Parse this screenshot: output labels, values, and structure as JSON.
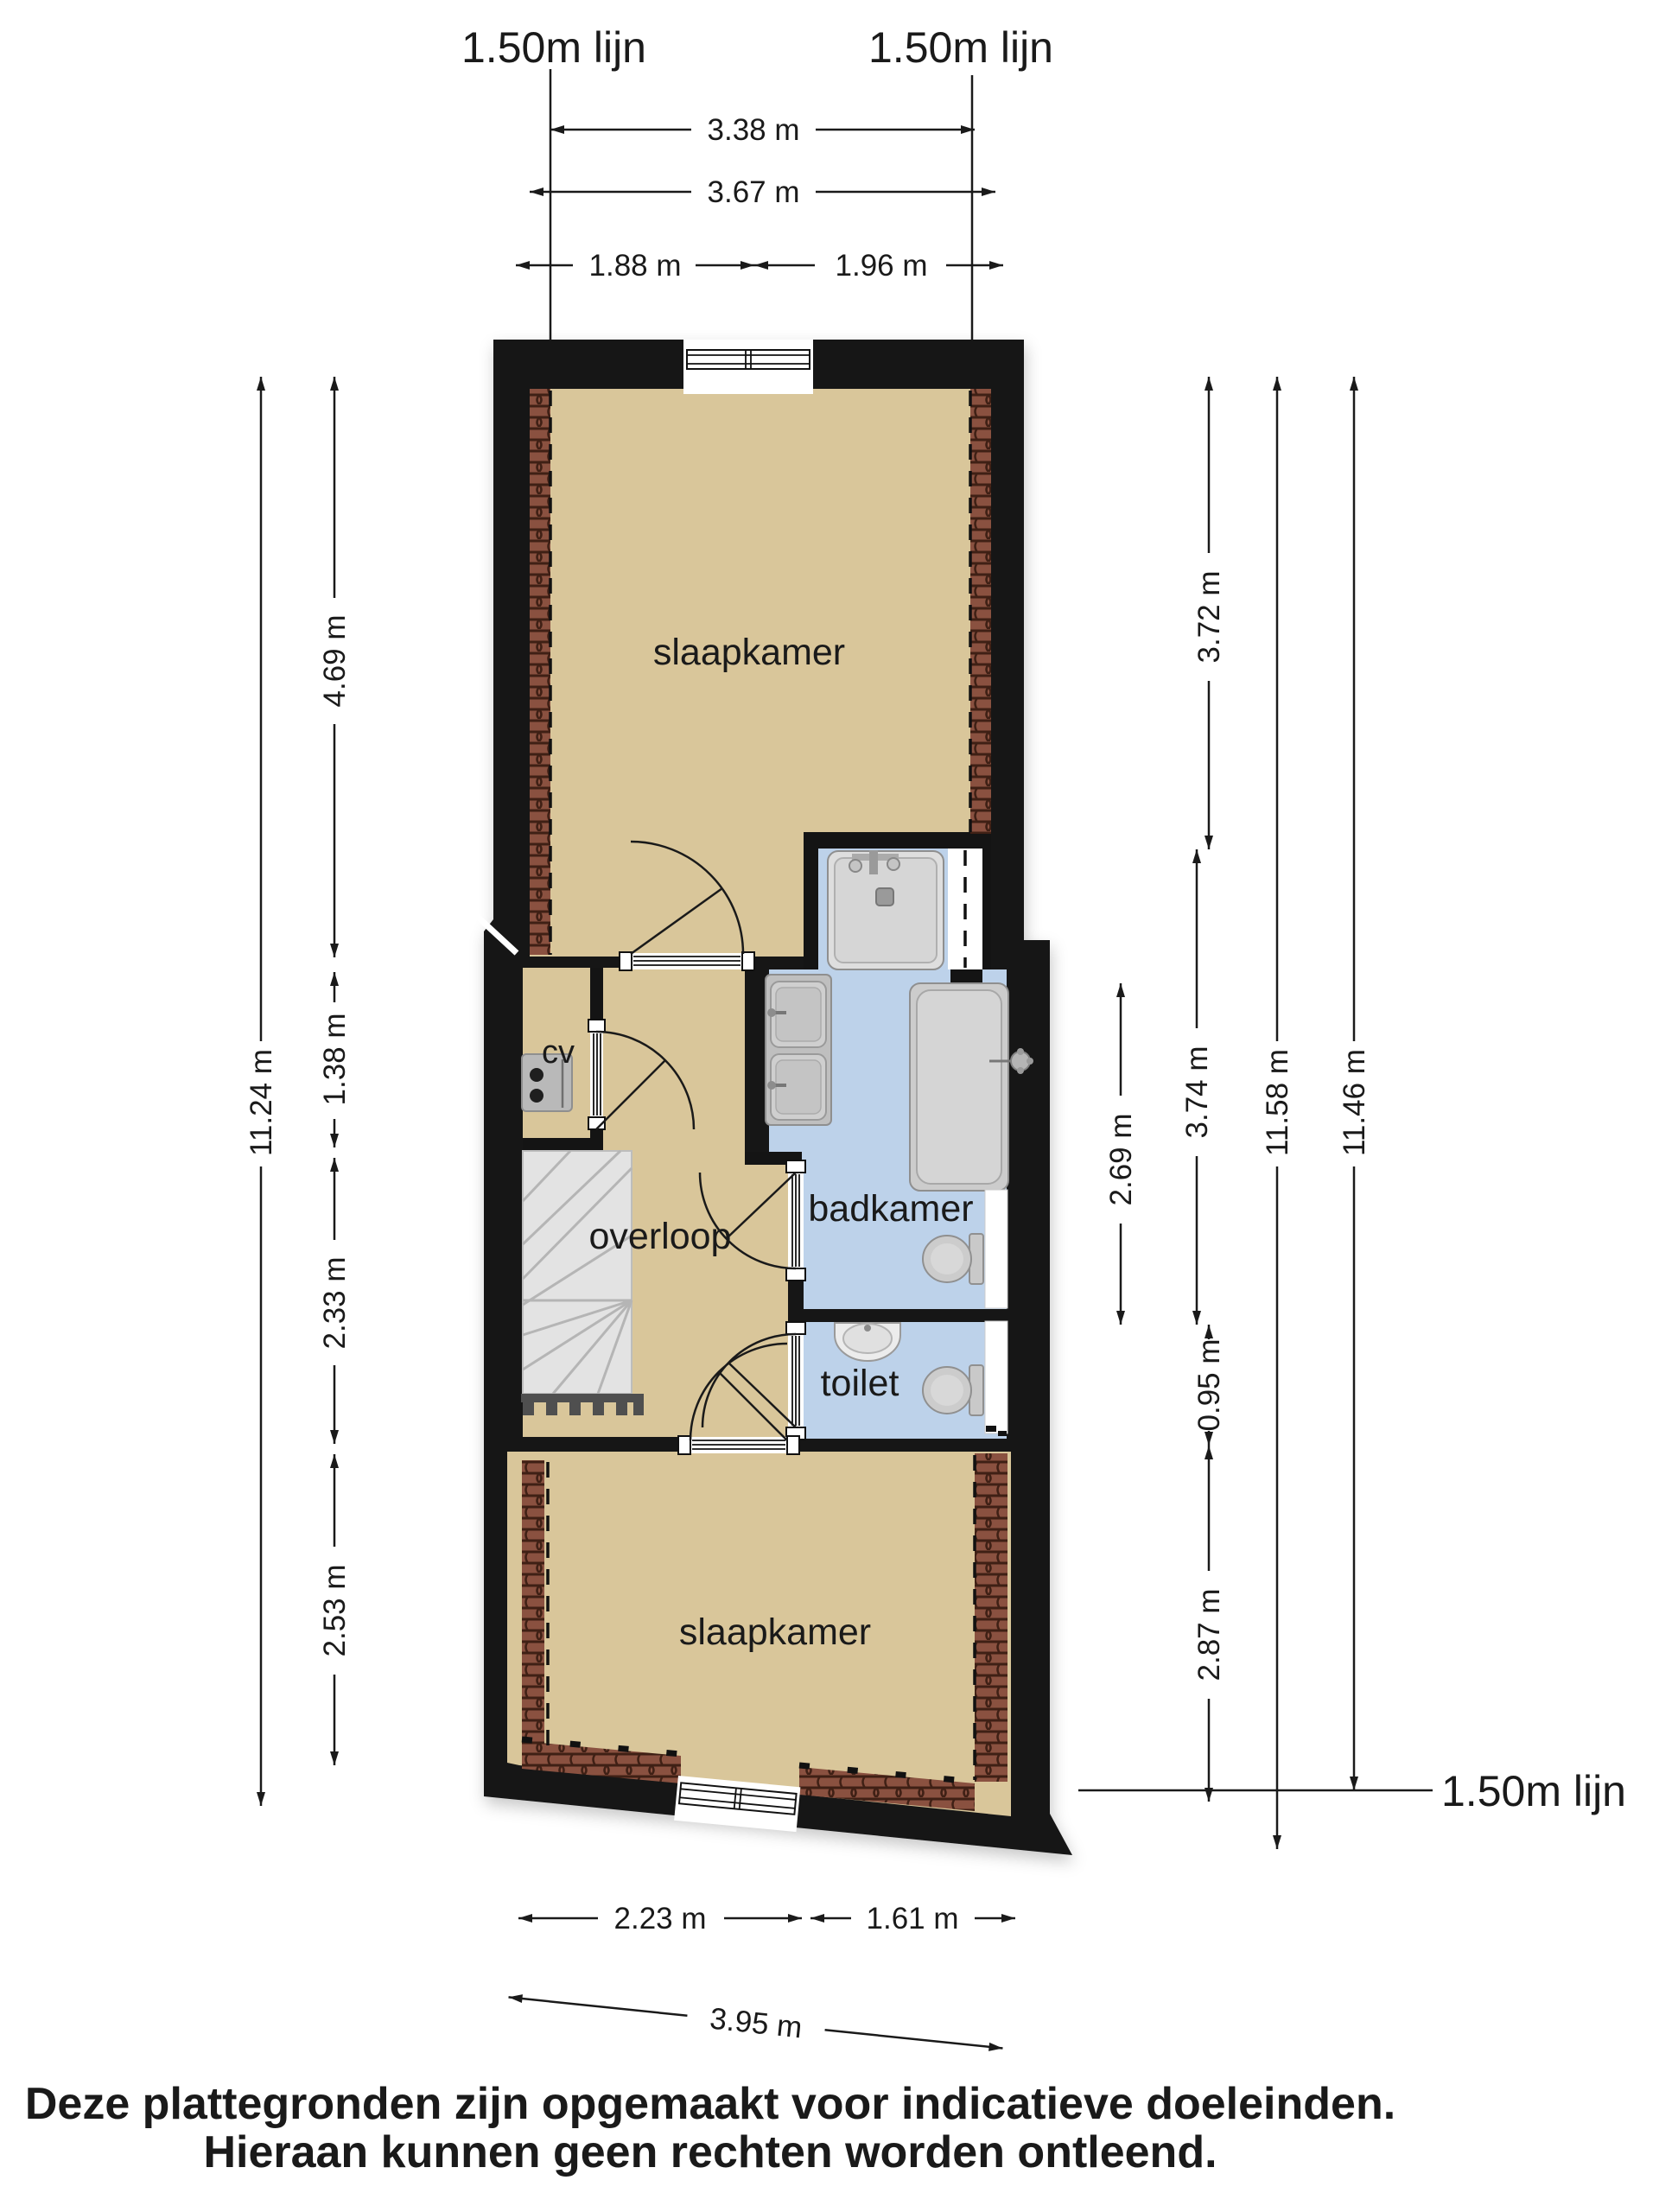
{
  "plan": {
    "lines_150": {
      "top_left": "1.50m lijn",
      "top_right": "1.50m lijn",
      "bottom_right": "1.50m lijn"
    },
    "rooms": {
      "bedroom_top": "slaapkamer",
      "bedroom_bottom": "slaapkamer",
      "landing": "overloop",
      "bathroom": "badkamer",
      "toilet": "toilet",
      "heater": "cv"
    },
    "dimensions": {
      "top": {
        "overall_a": "3.38 m",
        "overall_b": "3.67 m",
        "left": "1.88 m",
        "right": "1.96 m"
      },
      "left": {
        "total": "11.24 m",
        "seg1": "4.69 m",
        "seg2": "1.38 m",
        "seg3": "2.33 m",
        "seg4": "2.53 m"
      },
      "right": {
        "seg1": "3.72 m",
        "bath_inner": "2.69 m",
        "seg2": "3.74 m",
        "seg3": "0.95 m",
        "seg4": "2.87 m",
        "total_a": "11.58 m",
        "total_b": "11.46 m"
      },
      "bottom": {
        "left": "2.23 m",
        "right": "1.61 m",
        "overall": "3.95 m"
      }
    }
  },
  "footer": {
    "line1": "Deze plattegronden zijn opgemaakt voor indicatieve doeleinden.",
    "line2": "Hieraan kunnen geen rechten worden ontleend."
  },
  "colors": {
    "wall": "#141414",
    "floor_dry": "#d9c69a",
    "floor_wet": "#bdd2ea",
    "roof_tile": "#8a5140",
    "stairs": "#e3e3e3",
    "fixture": "#cccccc",
    "dim": "#1a1a1a"
  },
  "icons": {
    "shower": "shower-icon",
    "bathtub": "bathtub-icon",
    "double_washbasin": "double-washbasin-icon",
    "wc": "wc-icon",
    "hand_basin": "hand-basin-icon",
    "cv_boiler": "cv-boiler-icon",
    "stairs": "stairs-icon",
    "window": "window-icon",
    "door": "door-icon",
    "roof_slope": "roof-slope-hatch-icon"
  }
}
